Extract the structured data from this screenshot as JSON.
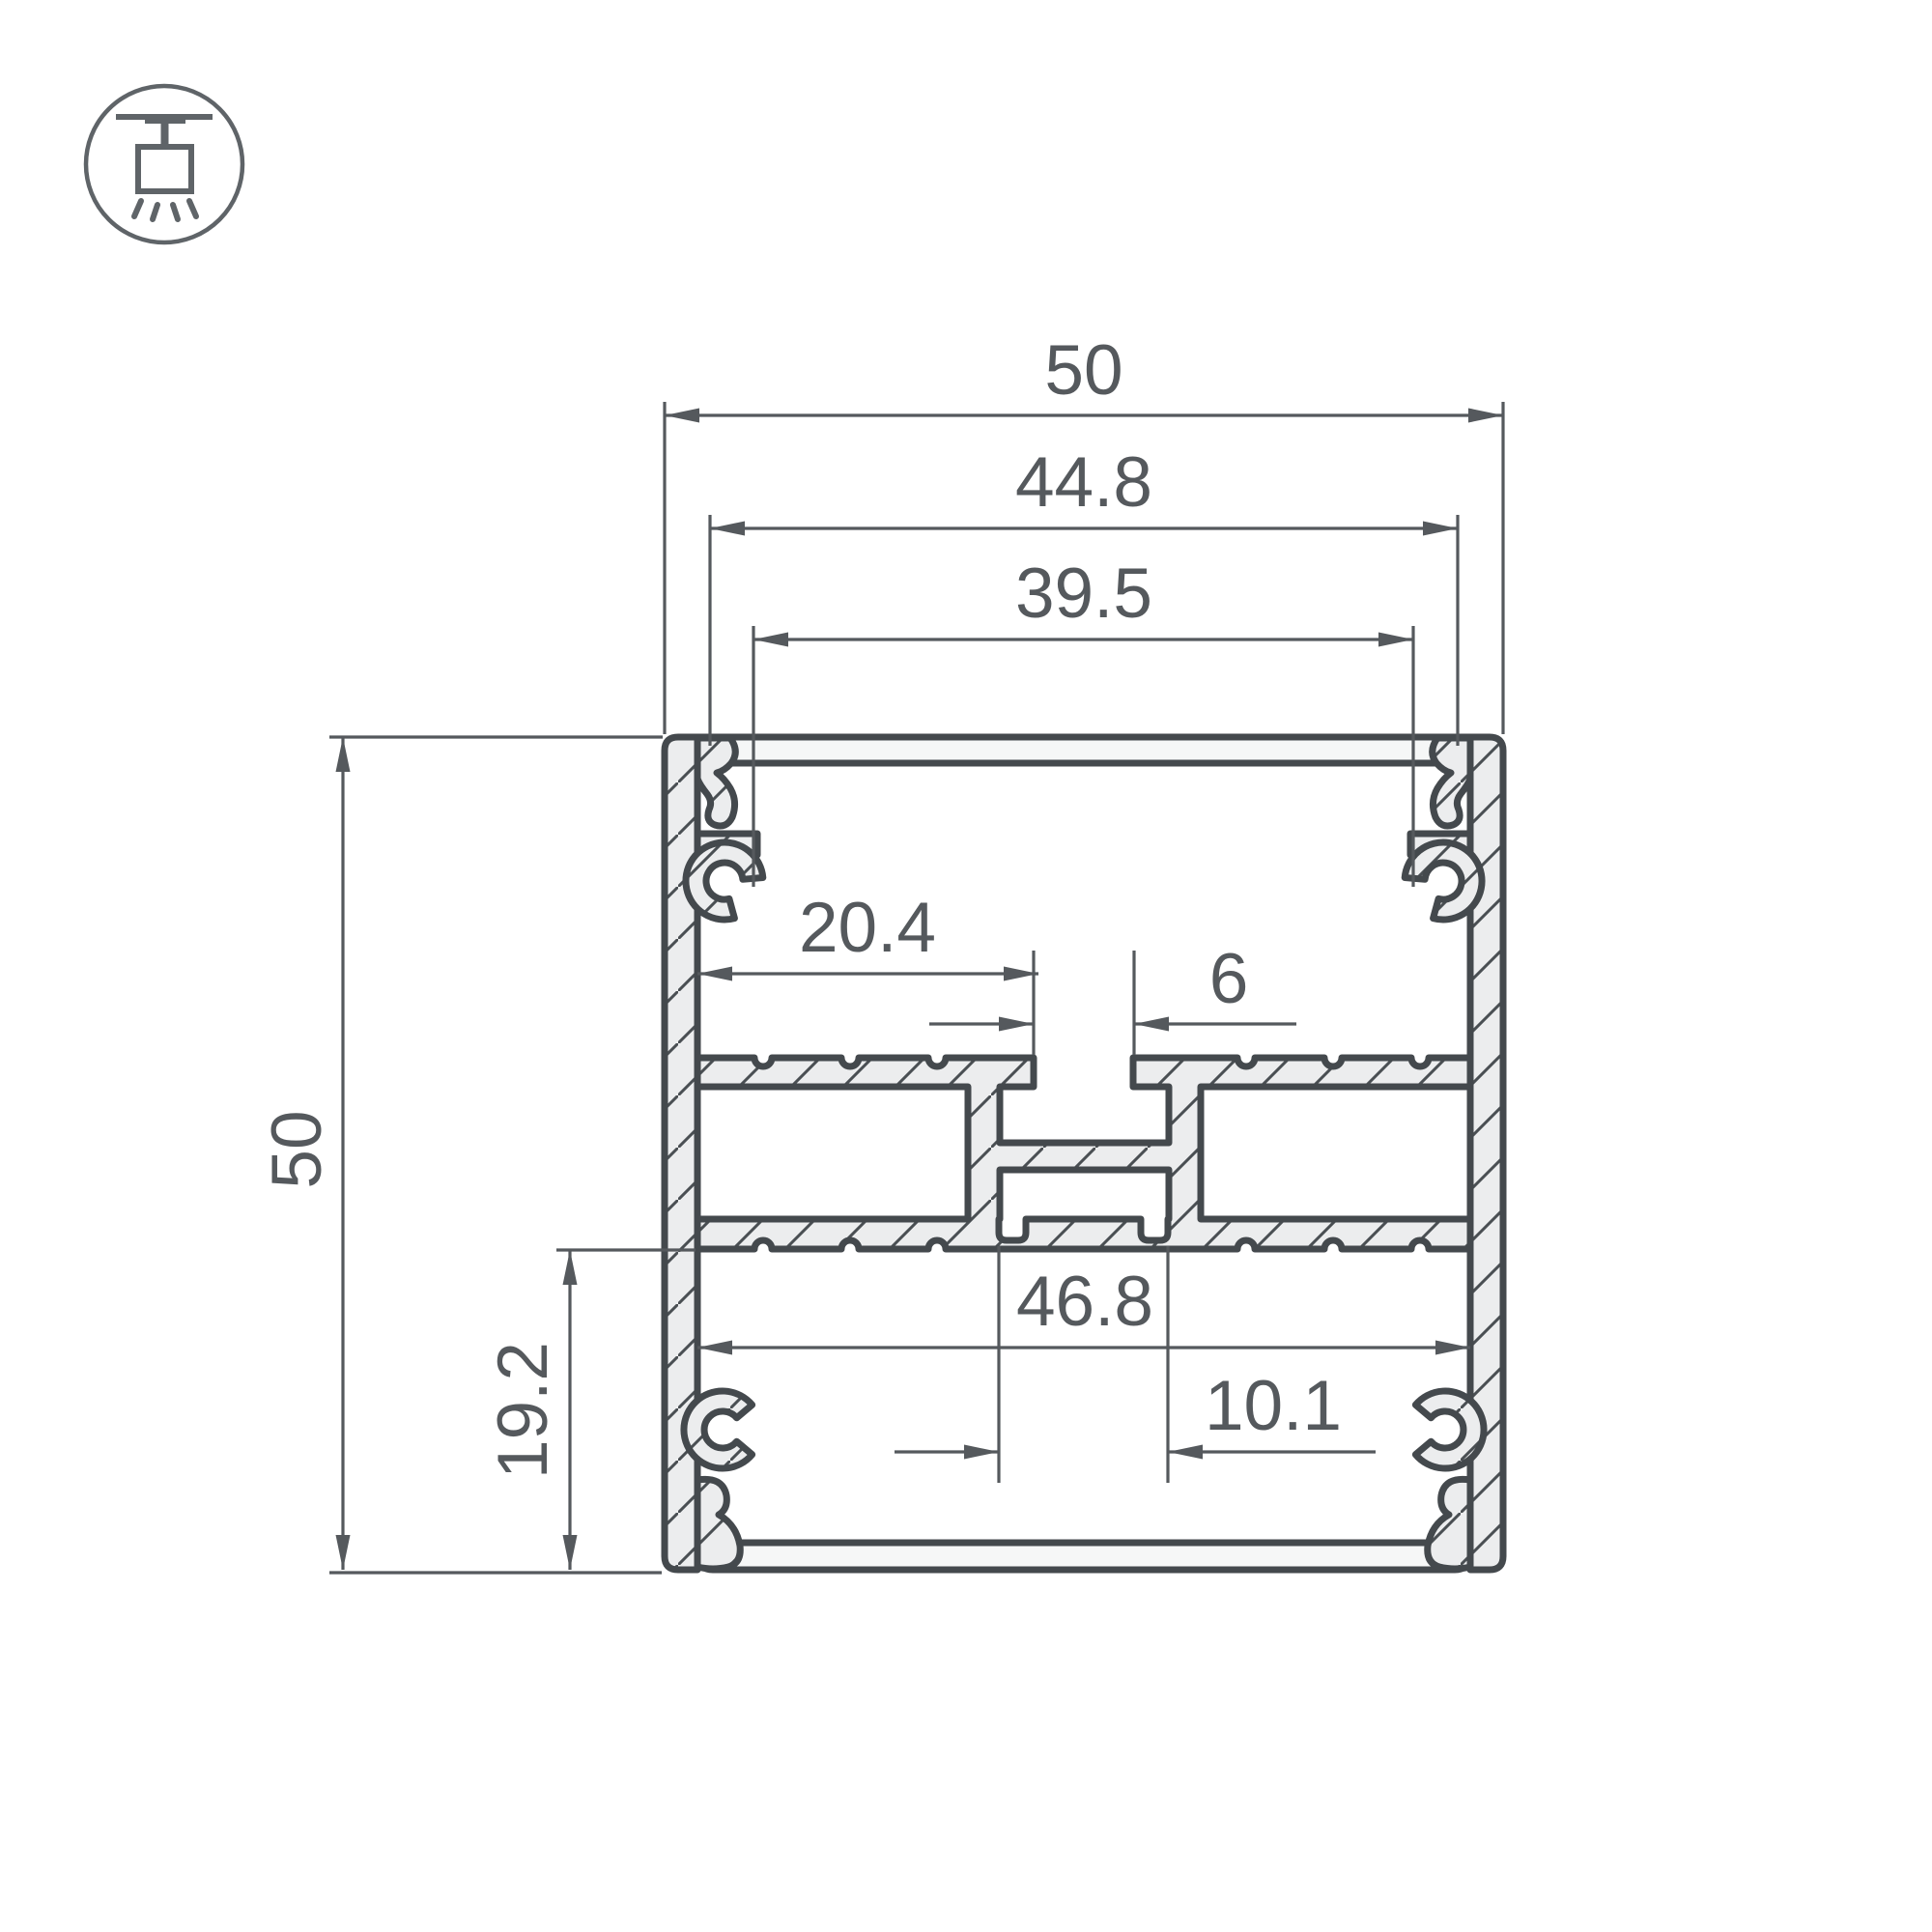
{
  "icon": {
    "name": "ceiling-pendant-light"
  },
  "dims": {
    "overall_width": "50",
    "top_inner_width": "44.8",
    "top_groove_width": "39.5",
    "overall_height": "50",
    "shelf_width": "20.4",
    "center_slot_width": "6",
    "bottom_inner_width": "46.8",
    "bottom_section_height": "19.2",
    "center_block_width": "10.1"
  },
  "colors": {
    "outline": "#44494d",
    "metal_fill": "#ecedee",
    "dimension": "#55595d",
    "background": "#ffffff"
  }
}
